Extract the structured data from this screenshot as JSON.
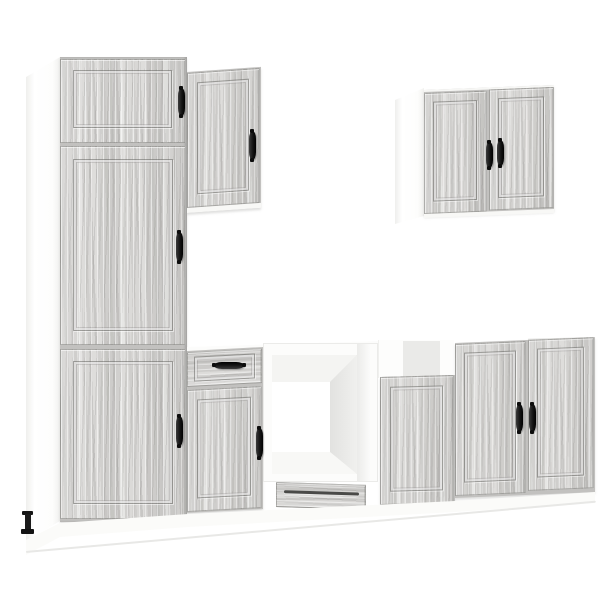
{
  "meta": {
    "description": "Product photo of a 7-piece kitchen cabinet furniture set in grey Sonoma oak wood finish with black bow handles, shown against a plain white background",
    "background_color": "#ffffff"
  },
  "palette": {
    "wood_light": "#dedddb",
    "wood_mid": "#d5d4d2",
    "wood_dark": "#c8c7c5",
    "grain_shadow": "#8a8986",
    "carcass_white": "#fdfdfc",
    "interior_shadow": "#ededeb",
    "open_back_grey": "#eaeae8",
    "handle_black": "#1a1a1a",
    "floor_shadow": "#e8e8e6"
  },
  "scene": {
    "items": [
      {
        "id": "tall-pantry-cabinet",
        "label": "Tall pantry cabinet with three framed doors and black handles, white side panel"
      },
      {
        "id": "wall-cabinet-single",
        "label": "Single-door wall cabinet mounted beside the tall cabinet"
      },
      {
        "id": "wall-cabinet-double",
        "label": "Double-door wall cabinet with white side panel, top right"
      },
      {
        "id": "base-cabinet-drawer",
        "label": "Base cabinet with top drawer and framed door"
      },
      {
        "id": "oven-housing-cabinet",
        "label": "Open oven housing cabinet with white interior and bottom drawer"
      },
      {
        "id": "base-cabinet-plain",
        "label": "Base cabinet with framed door and open top showing grey back panel"
      },
      {
        "id": "base-cabinet-double",
        "label": "Double-door base cabinet on the right with centered black handles"
      },
      {
        "id": "plinth",
        "label": "White plinth running under the base cabinets"
      },
      {
        "id": "cabinet-leg",
        "label": "Black adjustable cabinet foot at lower left"
      }
    ],
    "handle_count": 10,
    "door_count": 9,
    "drawer_count": 2
  }
}
